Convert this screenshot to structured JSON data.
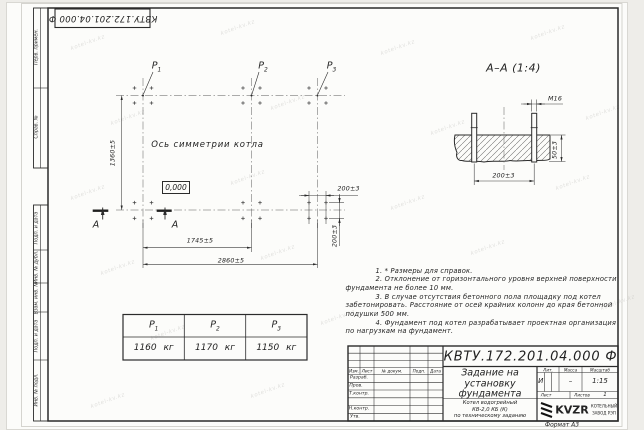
{
  "sheet": {
    "doc_number": "КВТУ.172.201.04.000 Ф",
    "format_label": "Формат А3",
    "watermark": "kotel-kv.kz"
  },
  "margin_labels": [
    "Перв. примен.",
    "Справ. №",
    "Подп. и дата",
    "Инв. № дубл.",
    "Взам. инв. №",
    "Подп. и дата",
    "Инв. № подл."
  ],
  "plan": {
    "loads": [
      {
        "base": "P",
        "sub": "1"
      },
      {
        "base": "P",
        "sub": "2"
      },
      {
        "base": "P",
        "sub": "3"
      }
    ],
    "axis_label": "Ось симметрии котла",
    "level_mark": "0,000",
    "section_mark": "А",
    "dim_height": "1360±5",
    "dim_width_inner": "1745±5",
    "dim_width_outer": "2860±5",
    "dim_bolt_h": "200±3",
    "dim_bolt_v": "200±3"
  },
  "section": {
    "title": "А–А (1:4)",
    "dim_thread": "М16",
    "dim_depth": "50±3",
    "dim_spacing": "200±3"
  },
  "load_table": {
    "headers": [
      {
        "base": "P",
        "sub": "1"
      },
      {
        "base": "P",
        "sub": "2"
      },
      {
        "base": "P",
        "sub": "3"
      }
    ],
    "values": [
      "1160 кг",
      "1170 кг",
      "1150 кг"
    ]
  },
  "notes": {
    "lines": [
      "1. * Размеры для справок.",
      "2. Отклонение от горизонтального уровня верхней поверхности",
      "фундамента не более 10 мм.",
      "3. В случае отсутствия бетонного пола площадку под котел",
      "забетонировать. Расстояние от осей крайних колонн до края бетонной",
      "подушки 500 мм.",
      "4. Фундамент под котел разрабатывает проектная организация",
      "по нагрузкам на фундамент."
    ]
  },
  "titleblock": {
    "doc_number": "КВТУ.172.201.04.000 Ф",
    "title_lines": [
      "Задание на",
      "установку",
      "фундамента"
    ],
    "subtitle_lines": [
      "Котел водогрейный",
      "КВ-2,0 КБ (К)",
      "по техническому заданию"
    ],
    "header_cols": [
      "Изм.",
      "Лист",
      "№ докум.",
      "Подп.",
      "Дата"
    ],
    "sig_rows": [
      "Разраб.",
      "Пров.",
      "Т.контр.",
      "Н.контр.",
      "Утв."
    ],
    "lit_label": "Лит.",
    "lit_value": "И",
    "mass_label": "Масса",
    "mass_value": "–",
    "scale_label": "Масштаб",
    "scale_value": "1:15",
    "sheet_label": "Лист",
    "sheets_label": "Листов",
    "sheets_value": "1",
    "logo_text": "KVZR",
    "logo_caption": [
      "КОТЕЛЬНЫЙ",
      "ЗАВОД РЭП"
    ]
  }
}
